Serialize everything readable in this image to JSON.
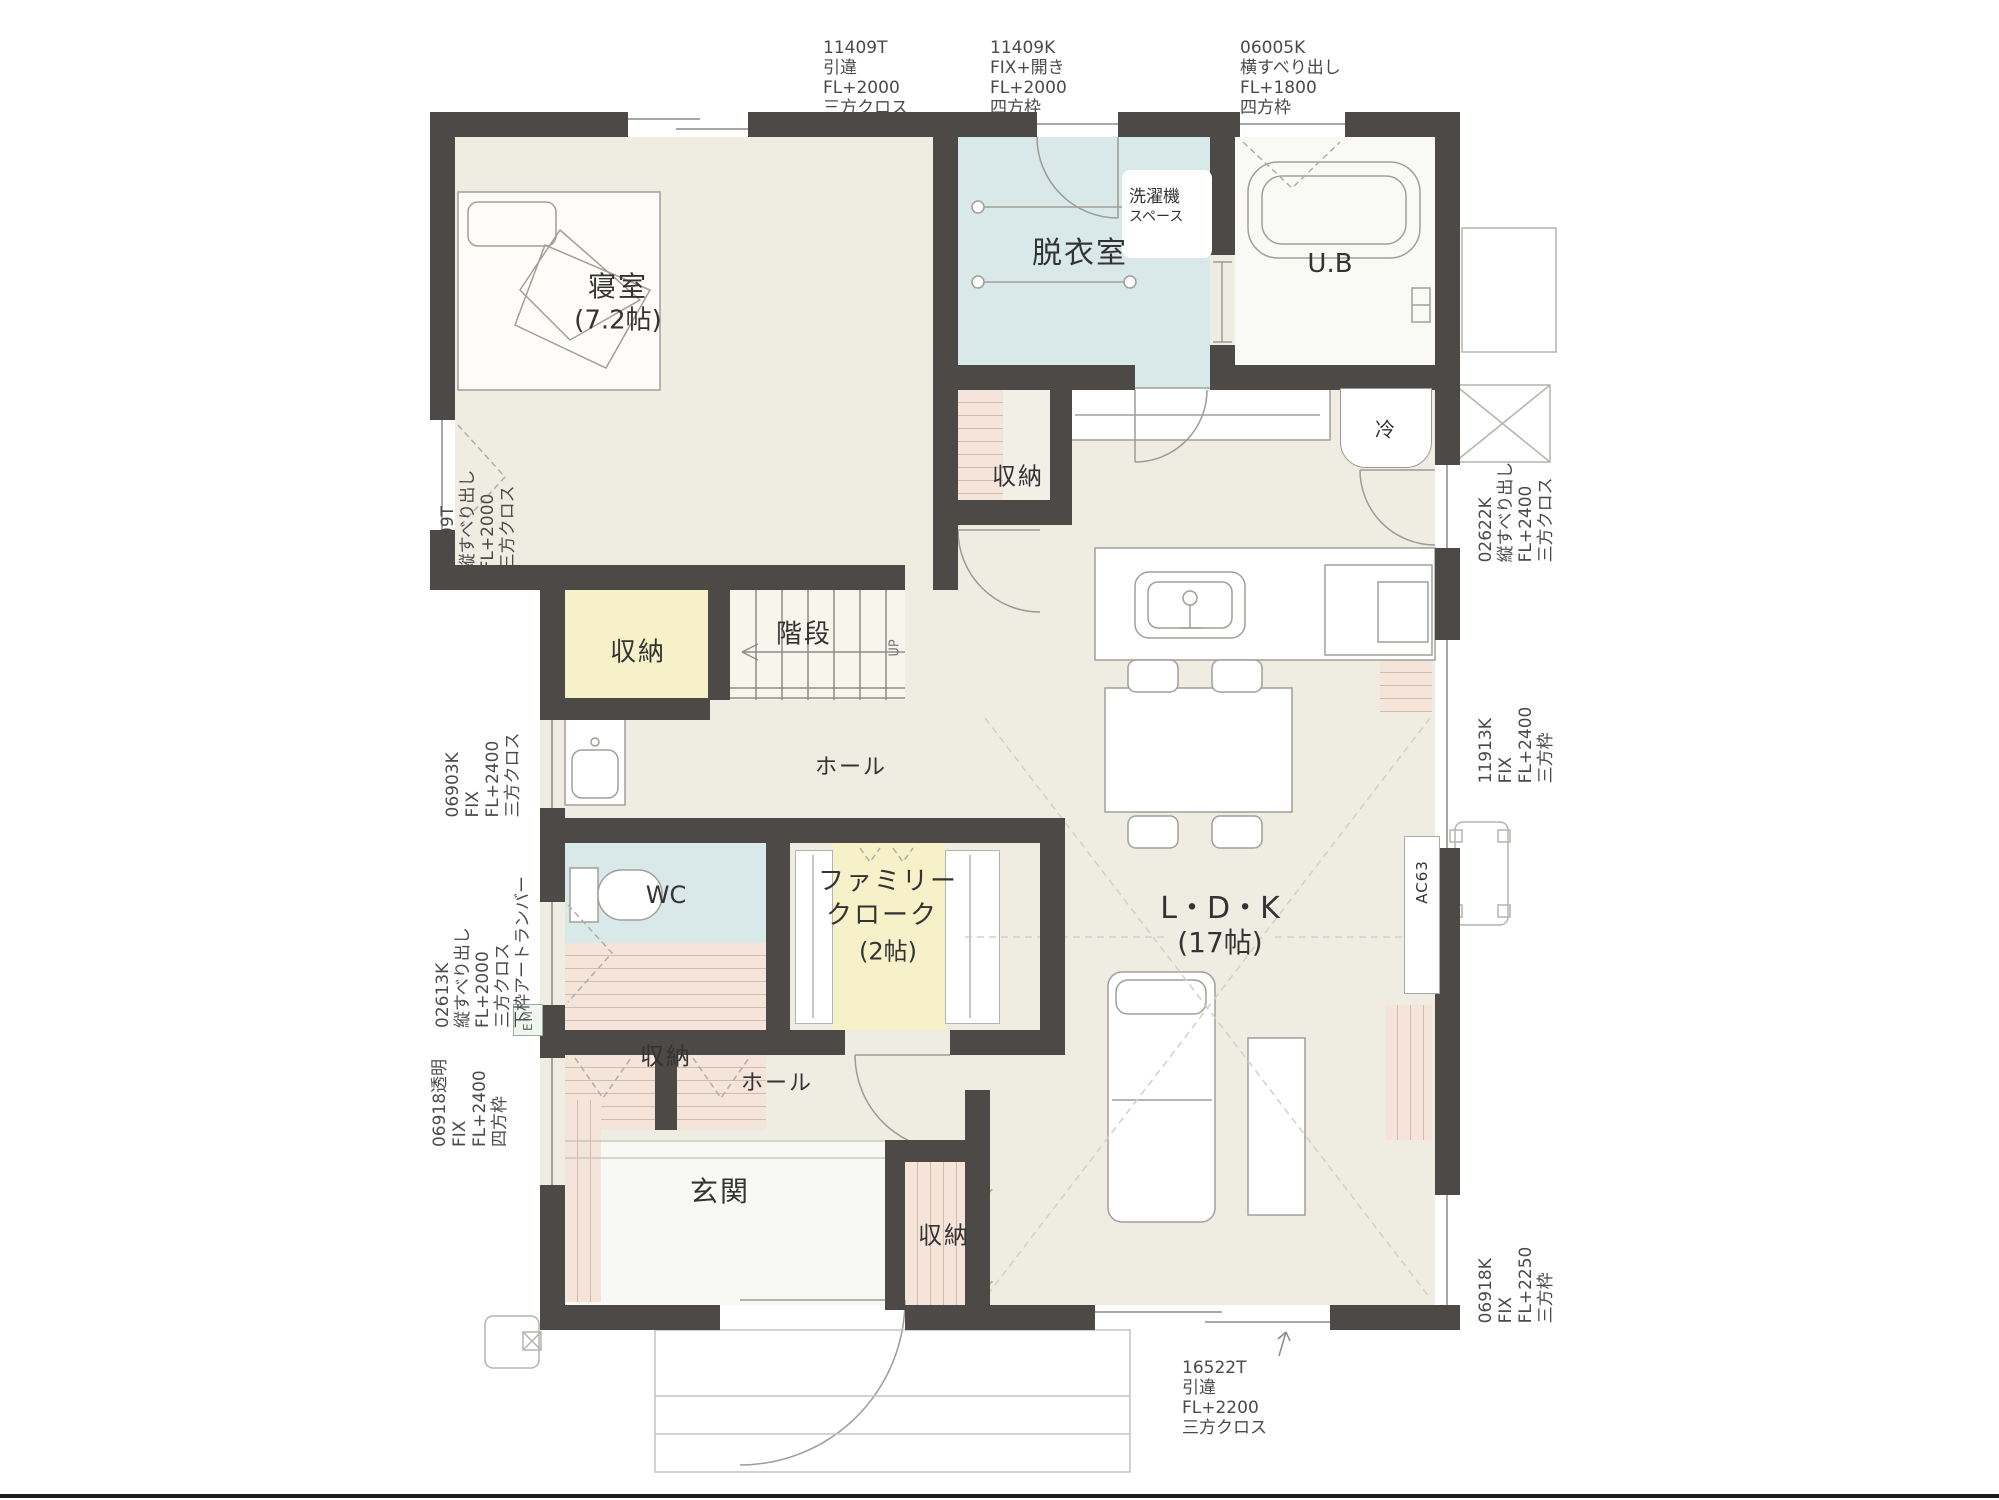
{
  "plan": {
    "rooms": {
      "bedroom": {
        "name": "寝室",
        "size": "(7.2帖)"
      },
      "dressing": {
        "name": "脱衣室"
      },
      "laundry": {
        "line1": "洗濯機",
        "line2": "スペース"
      },
      "bath": {
        "name": "U.B"
      },
      "closet_top": {
        "name": "収納"
      },
      "stairs": {
        "name": "階段",
        "up": "UP"
      },
      "closet_yellow": {
        "name": "収納"
      },
      "hall_upper": {
        "name": "ホール"
      },
      "wc": {
        "name": "WC"
      },
      "family_cloak": {
        "line1": "ファミリー",
        "line2": "クローク",
        "line3": "(2帖)"
      },
      "closet_lower": {
        "name": "収納"
      },
      "hall_lower": {
        "name": "ホール"
      },
      "ldk": {
        "name": "L・D・K",
        "size": "(17帖)"
      },
      "entrance": {
        "name": "玄関"
      },
      "closet_entrance": {
        "name": "収納"
      },
      "fridge": {
        "name": "冷"
      },
      "ac": {
        "name": "AC63"
      },
      "em": {
        "name": "EM"
      }
    },
    "annotations": {
      "top": [
        {
          "lines": [
            "11409T",
            "引違",
            "FL+2000",
            "三方クロス"
          ]
        },
        {
          "lines": [
            "11409K",
            "FIX+開き",
            "FL+2000",
            "四方枠"
          ]
        },
        {
          "lines": [
            "06005K",
            "横すべり出し",
            "FL+1800",
            "四方枠"
          ]
        }
      ],
      "left": [
        {
          "lines": [
            "06009T",
            "縦すべり出し",
            "FL+2000",
            "三方クロス"
          ]
        },
        {
          "lines": [
            "06903K",
            "FIX",
            "FL+2400",
            "三方クロス"
          ]
        },
        {
          "lines": [
            "02613K",
            "縦すべり出し",
            "FL+2000",
            "三方クロス",
            "下枠アートランバー"
          ]
        },
        {
          "lines": [
            "06918透明",
            "FIX",
            "FL+2400",
            "四方枠"
          ]
        }
      ],
      "right": [
        {
          "lines": [
            "02622K",
            "縦すべり出し",
            "FL+2400",
            "三方クロス"
          ]
        },
        {
          "lines": [
            "11913K",
            "FIX",
            "FL+2400",
            "三方枠"
          ]
        },
        {
          "lines": [
            "06918K",
            "FIX",
            "FL+2250",
            "三方枠"
          ]
        }
      ],
      "bottom": [
        {
          "lines": [
            "16522T",
            "引違",
            "FL+2200",
            "三方クロス"
          ]
        }
      ]
    },
    "colors": {
      "wall": "#4c4946",
      "floor": "#efece2",
      "wet_room": "#d9e8e8",
      "closet_yellow": "#f6f1c8",
      "shelf_pink": "#f4e4da",
      "annotation_text": "#4a4a4a"
    }
  }
}
